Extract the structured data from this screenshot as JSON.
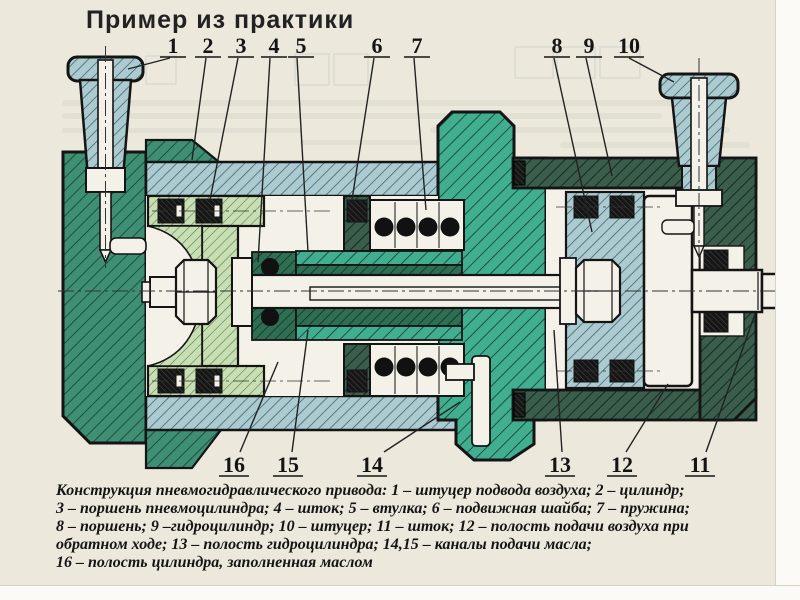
{
  "title": "Пример из практики",
  "figure": {
    "description": "Конструкция пневмогидравлического привода (cross-section engineering drawing)",
    "callouts": [
      {
        "number": "1",
        "label": "штуцер подвода воздуха"
      },
      {
        "number": "2",
        "label": "цилиндр"
      },
      {
        "number": "3",
        "label": "поршень пневмоцилиндра"
      },
      {
        "number": "4",
        "label": "шток"
      },
      {
        "number": "5",
        "label": "втулка"
      },
      {
        "number": "6",
        "label": "подвижная шайба"
      },
      {
        "number": "7",
        "label": "пружина"
      },
      {
        "number": "8",
        "label": "поршень"
      },
      {
        "number": "9",
        "label": "гидроцилиндр"
      },
      {
        "number": "10",
        "label": "штуцер"
      },
      {
        "number": "11",
        "label": "шток"
      },
      {
        "number": "12",
        "label": "полость подачи воздуха при обратном ходе"
      },
      {
        "number": "13",
        "label": "полость гидроцилиндра"
      },
      {
        "number": "14",
        "label": "канал подачи масла"
      },
      {
        "number": "15",
        "label": "канал подачи масла"
      },
      {
        "number": "16",
        "label": "полость цилиндра, заполненная маслом"
      }
    ],
    "colors": {
      "paper": "#ece8dc",
      "dark_green": "#3a5d4c",
      "cap_green": "#3f8f74",
      "teal": "#41ae90",
      "light_blue": "#abcbd1",
      "light_green": "#c8dfb4",
      "sleeve_green": "#2e6e52",
      "seal_black": "#161616",
      "white_metal": "#f4f1e8"
    }
  },
  "caption": {
    "lines": [
      "Конструкция пневмогидравлического привода: 1 – штуцер подвода воздуха; 2 – цилиндр;",
      "3 – поршень пневмоцилиндра; 4 – шток; 5 – втулка; 6 – подвижная шайба; 7 – пружина;",
      "8 – поршень; 9 –гидроцилиндр; 10 – штуцер; 11 – шток; 12 – полость подачи воздуха при",
      "обратном ходе; 13 – полость гидроцилиндра; 14,15 – каналы подачи масла;",
      "16 – полость цилиндра, заполненная маслом"
    ]
  }
}
